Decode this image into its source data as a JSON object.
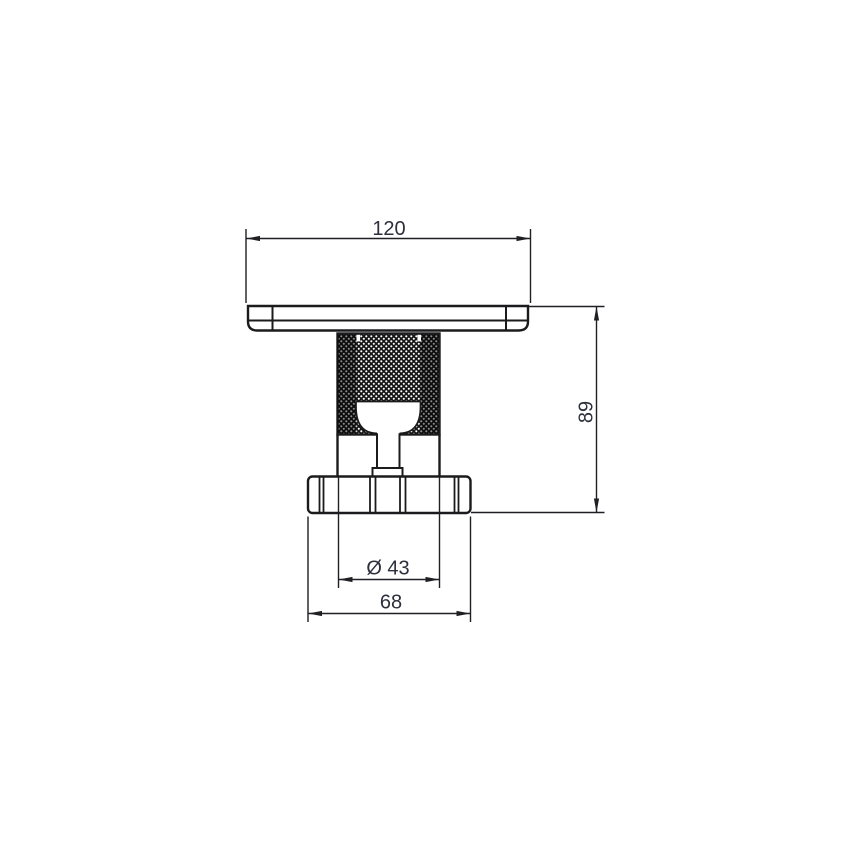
{
  "page": {
    "background_color": "#ffffff",
    "line_color": "#1b1b1d",
    "text_color": "#2c2f3c"
  },
  "drawing": {
    "dimensions": {
      "overall_width": "120",
      "overall_height": "89",
      "knob_diameter": "Ø 43",
      "base_width": "68"
    }
  }
}
